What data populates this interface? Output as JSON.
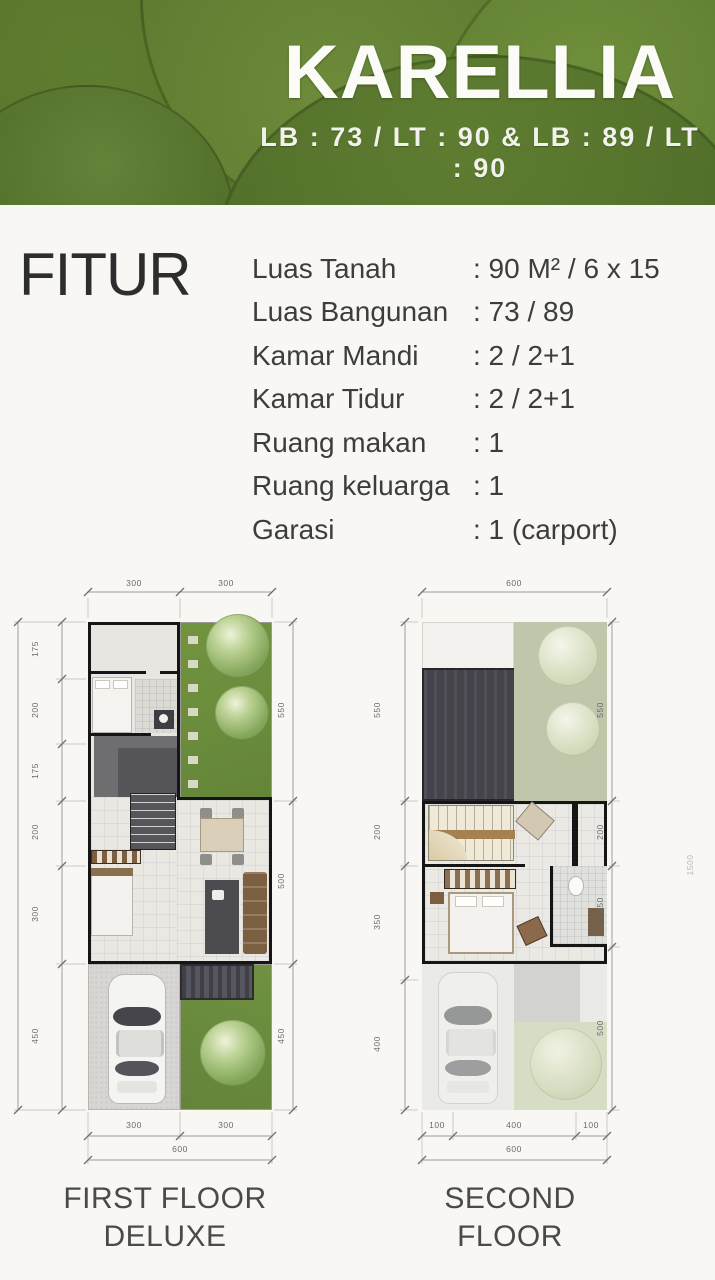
{
  "header": {
    "title": "KARELLIA",
    "subtitle": "LB : 73 / LT : 90 & LB : 89 / LT : 90"
  },
  "fitur": {
    "heading": "FITUR",
    "items": [
      {
        "label": "Luas Tanah",
        "value": ": 90 M² / 6 x 15"
      },
      {
        "label": "Luas Bangunan",
        "value": ": 73 / 89"
      },
      {
        "label": "Kamar Mandi",
        "value": ": 2 / 2+1"
      },
      {
        "label": "Kamar Tidur",
        "value": ": 2 / 2+1"
      },
      {
        "label": "Ruang makan",
        "value": ": 1"
      },
      {
        "label": "Ruang keluarga",
        "value": ": 1"
      },
      {
        "label": "Garasi",
        "value": ": 1 (carport)"
      }
    ]
  },
  "plans": {
    "first": {
      "caption_line1": "FIRST FLOOR",
      "caption_line2": "DELUXE",
      "dims": {
        "top": [
          "300",
          "300"
        ],
        "bottom": [
          "300",
          "300"
        ],
        "bottom_total": "600",
        "left": [
          "175",
          "200",
          "175",
          "200",
          "300",
          "450"
        ],
        "left_total": "1500",
        "right": [
          "550",
          "500",
          "450"
        ]
      }
    },
    "second": {
      "caption_line1": "SECOND FLOOR",
      "dims": {
        "top": [
          "600"
        ],
        "bottom": [
          "100",
          "400",
          "100"
        ],
        "bottom_total": "600",
        "left": [
          "550",
          "200",
          "350",
          "400"
        ],
        "right": [
          "550",
          "200",
          "250",
          "500"
        ],
        "right_outer_partial": "1500"
      }
    }
  },
  "colors": {
    "header_green": "#5c7c2e",
    "garden_green": "#6e9040",
    "roof_garden_sage": "#bec7aa",
    "roof_dark": "#46464c",
    "wall_black": "#151515",
    "heading_text": "#2d2d2d",
    "dim_text": "#6a6a6a"
  }
}
